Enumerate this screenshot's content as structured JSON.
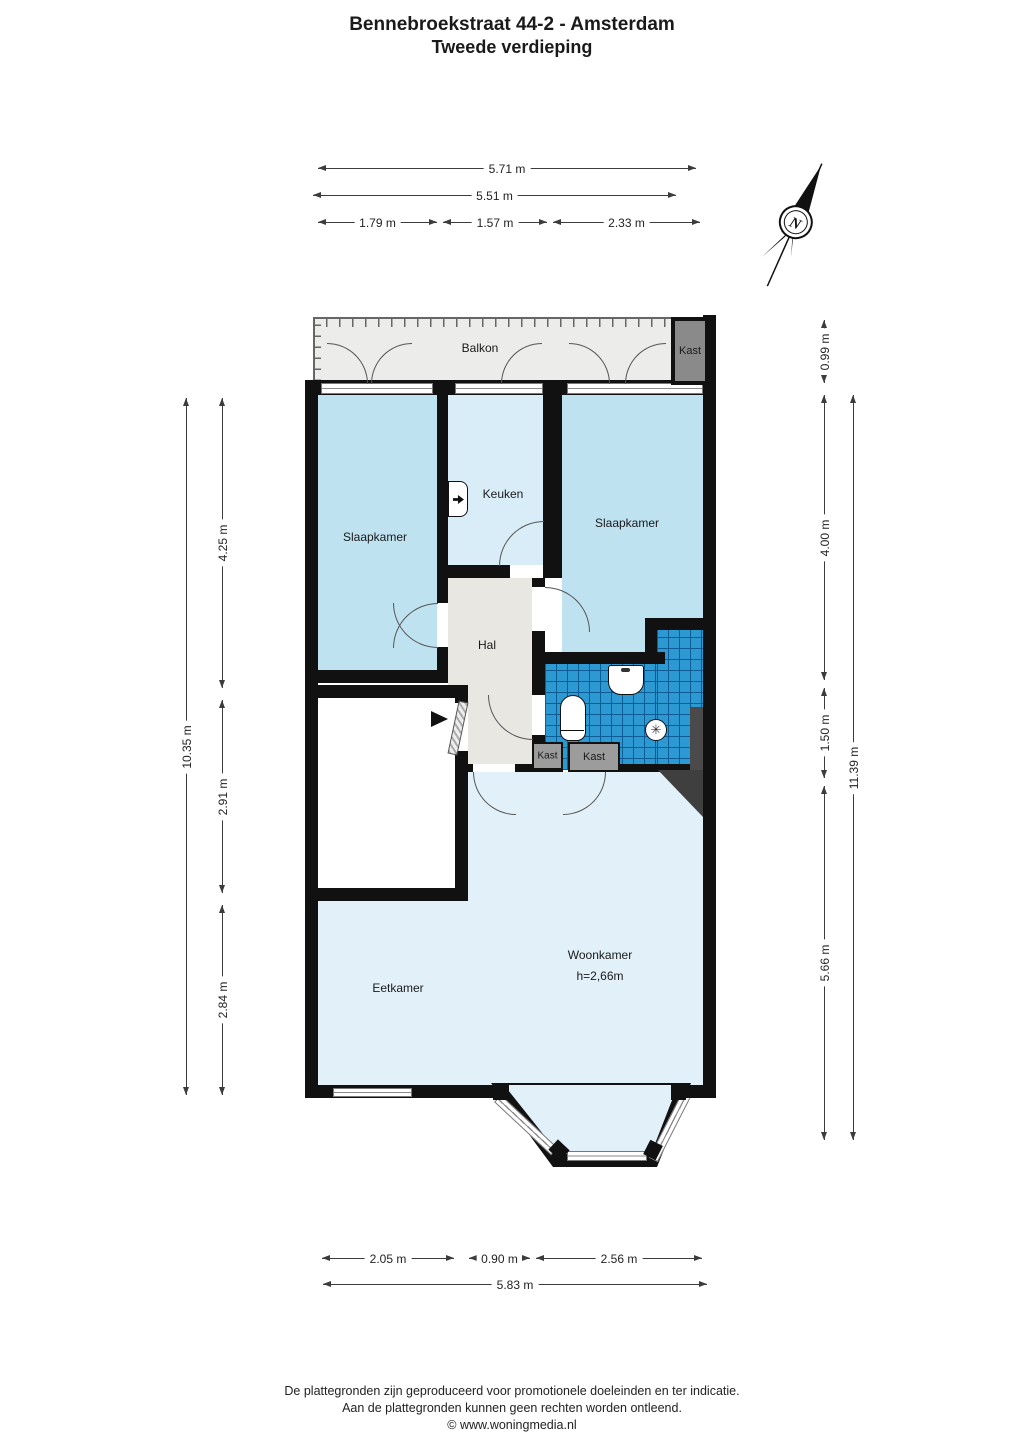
{
  "header": {
    "title": "Bennebroekstraat 44-2 - Amsterdam",
    "subtitle": "Tweede verdieping"
  },
  "compass": {
    "north_label": "N"
  },
  "rooms": {
    "balkon": "Balkon",
    "kast_balkon": "Kast",
    "slaapkamer_left": "Slaapkamer",
    "keuken": "Keuken",
    "slaapkamer_right": "Slaapkamer",
    "hal": "Hal",
    "kast_small_1": "Kast",
    "kast_small_2": "Kast",
    "woonkamer": "Woonkamer",
    "woonkamer_height": "h=2,66m",
    "eetkamer": "Eetkamer"
  },
  "fixtures": [
    "sink-icon",
    "washbasin-icon",
    "toilet-icon",
    "shower-icon",
    "entrance-arrow-icon"
  ],
  "dimensions": {
    "top": [
      "5.71 m",
      "5.51 m",
      "1.79 m",
      "1.57 m",
      "2.33 m"
    ],
    "left": [
      "10.35 m",
      "4.25 m",
      "2.91 m",
      "2.84 m"
    ],
    "right": [
      "0.99 m",
      "4.00 m",
      "1.50 m",
      "5.66 m",
      "11.39 m"
    ],
    "bottom": [
      "2.05 m",
      "0.90 m",
      "2.56 m",
      "5.83 m"
    ]
  },
  "footer": {
    "line1": "De plattegronden zijn geproduceerd voor promotionele doeleinden en ter indicatie.",
    "line2": "Aan de plattegronden kunnen geen rechten worden ontleend.",
    "line3": "© www.woningmedia.nl"
  },
  "colors": {
    "wall": "#111111",
    "bedroom": "#bfe2f1",
    "kitchen": "#d8edf8",
    "living": "#e2f0f9",
    "hall": "#e8e7e2",
    "balcony": "#ececea",
    "closet": "#9c9c9c",
    "closetdark": "#8a8a8a",
    "tiles": "#2d99d3",
    "tilegrid": "#0d5c96",
    "accentdark": "#3f3f3f",
    "dim": "#3c3c3c"
  }
}
